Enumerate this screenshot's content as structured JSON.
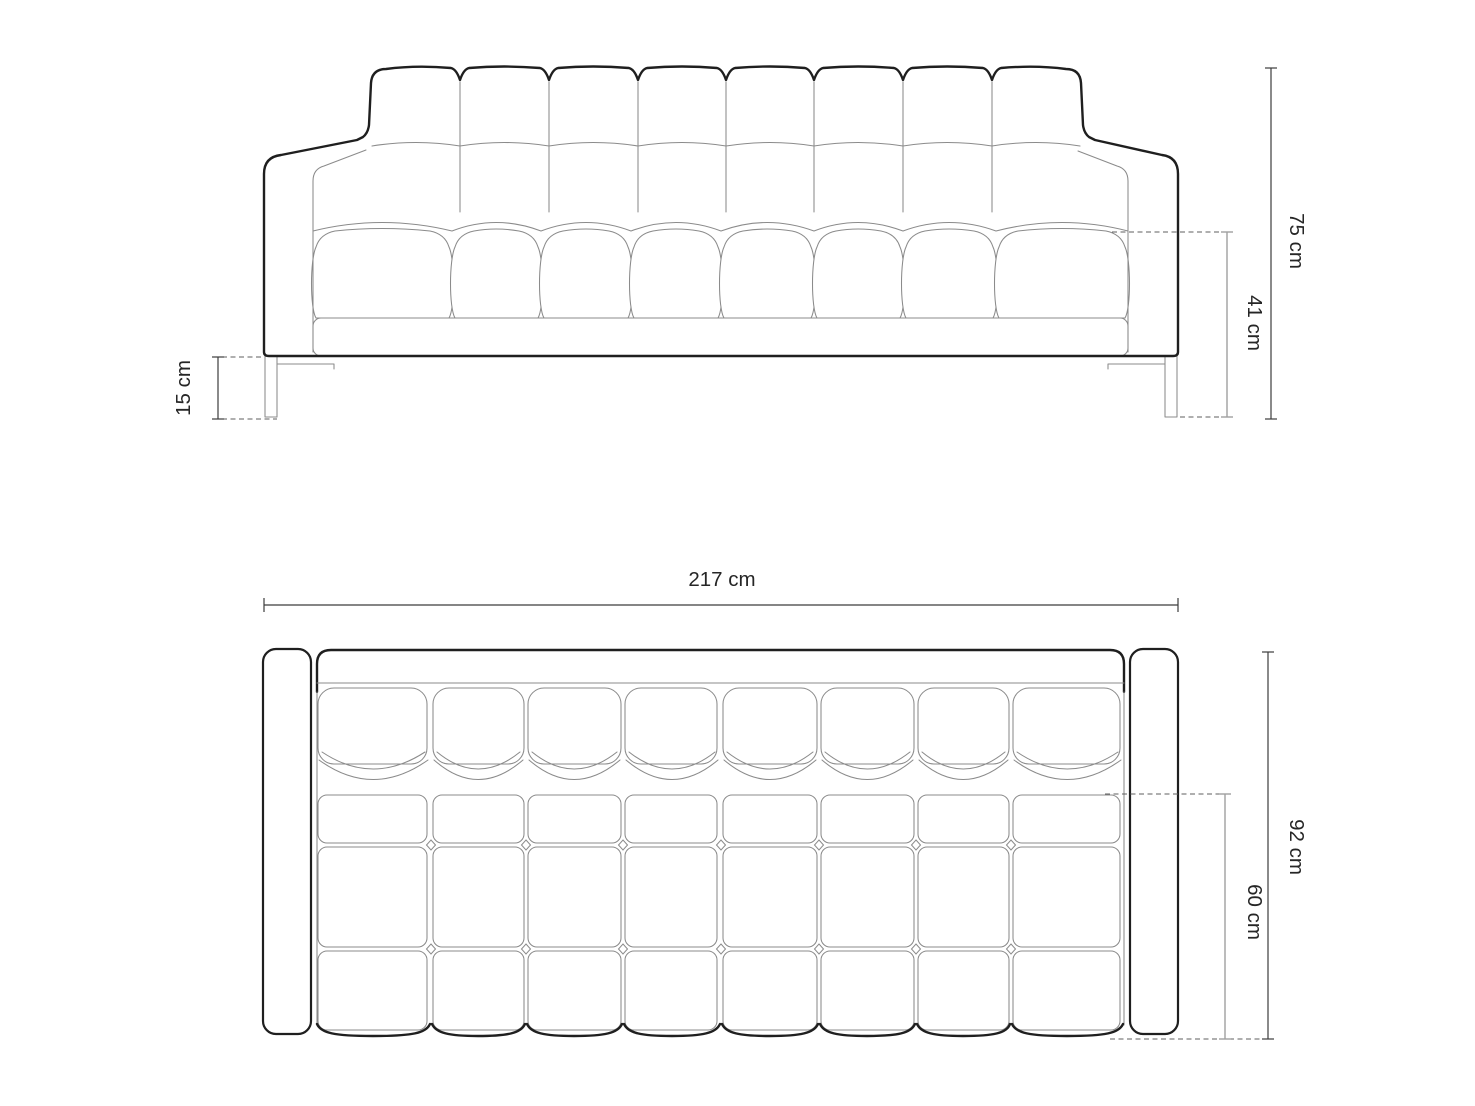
{
  "colors": {
    "background": "#ffffff",
    "outline": "#1f1f1f",
    "detail_line": "#8b8b8b",
    "dimension_dark": "#3c3c3c",
    "dimension_light": "#a0a0a0",
    "label_text": "#262626"
  },
  "front_view": {
    "overall_height_label": "75 cm",
    "seat_height_label": "41 cm",
    "leg_height_label": "15 cm"
  },
  "top_view": {
    "overall_width_label": "217 cm",
    "overall_depth_label": "92 cm",
    "seat_depth_label": "60 cm"
  }
}
